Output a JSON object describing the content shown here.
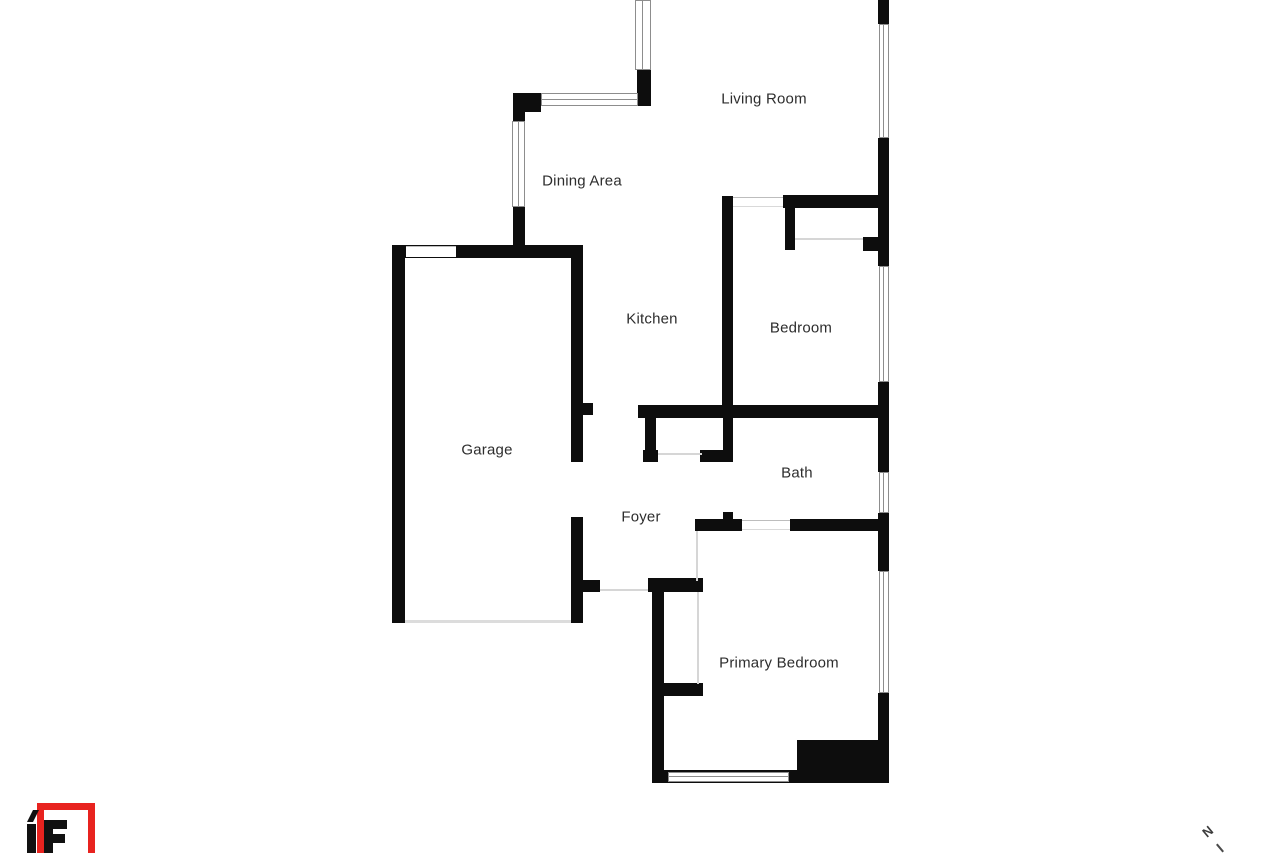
{
  "floor_plan": {
    "rooms": {
      "living_room": "Living Room",
      "dining_area": "Dining Area",
      "kitchen": "Kitchen",
      "bedroom": "Bedroom",
      "garage": "Garage",
      "bath": "Bath",
      "foyer": "Foyer",
      "primary_bedroom": "Primary Bedroom"
    }
  },
  "branding": {
    "logo_text": "1F",
    "logo_accent_color": "#e8231f"
  },
  "compass": {
    "north_label": "N"
  },
  "palette": {
    "wall": "#0d0d0d",
    "window_border": "#8d8d8d",
    "door_line": "#d6d6d6",
    "label_text": "#2d2d2d",
    "background": "#ffffff"
  }
}
